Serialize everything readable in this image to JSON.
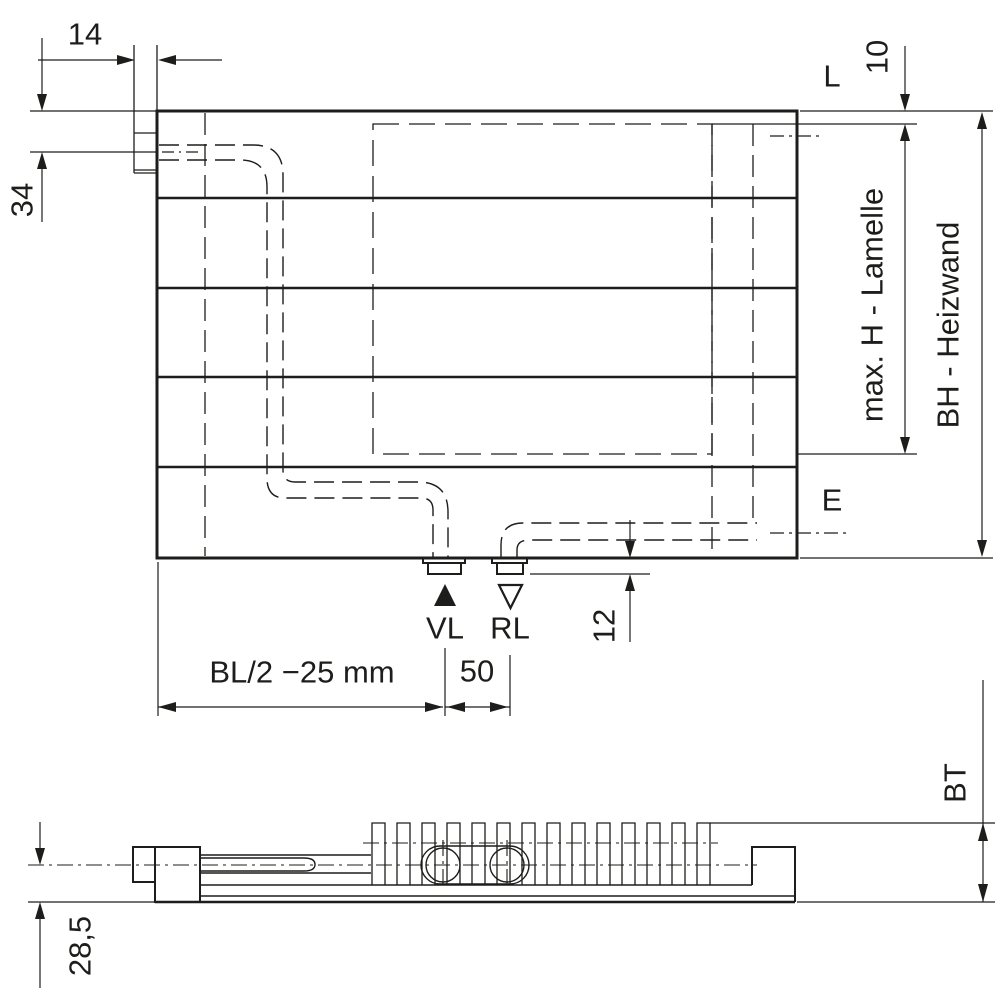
{
  "drawing": {
    "labels": {
      "tab_width": "14",
      "inlet_offset": "34",
      "top_clearance": "10",
      "air_vent": "L",
      "drain": "E",
      "lamelle_height": "max. H - Lamelle",
      "heizwand_height": "BH - Heizwand",
      "supply": "VL",
      "return_flow": "RL",
      "connector_depth": "12",
      "supply_position": "BL/2 −25 mm",
      "connection_spacing": "50",
      "build_depth": "BT",
      "axis_height": "28,5"
    },
    "colors": {
      "line": "#1d1d1b",
      "background": "#ffffff"
    }
  }
}
